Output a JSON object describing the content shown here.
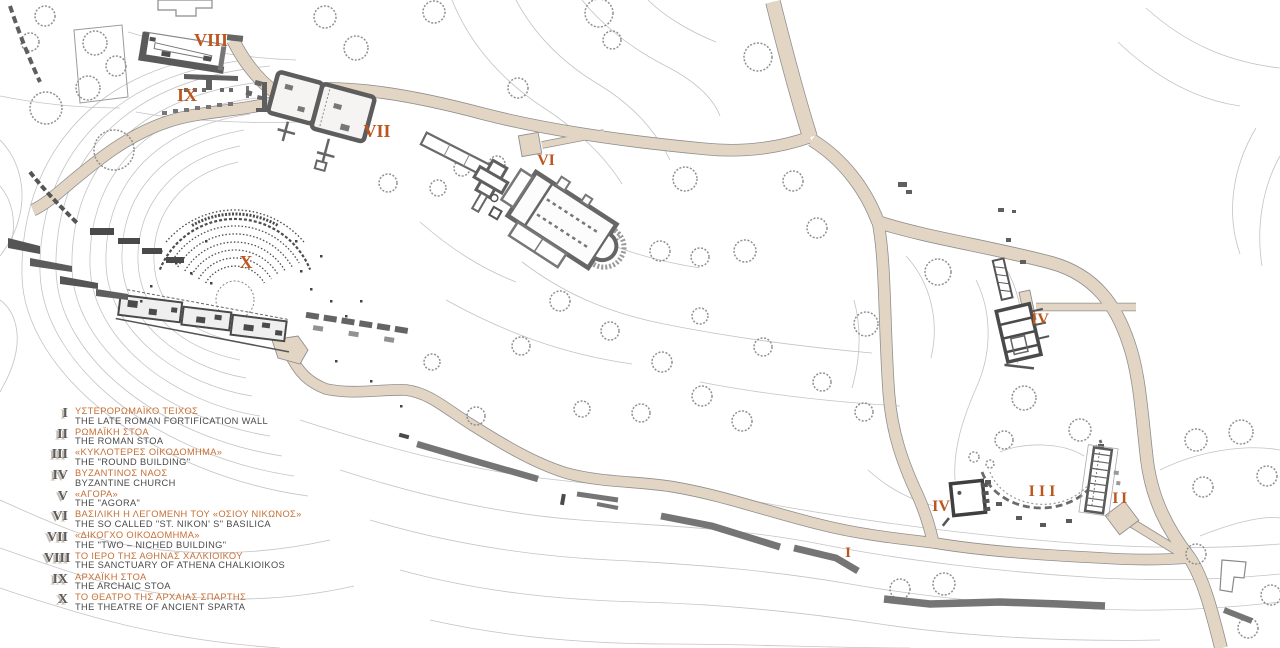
{
  "title": "Archaeological site plan of the acropolis of ancient Sparta",
  "colors": {
    "road_fill": "#e3d5c3",
    "road_edge": "#8f8f8f",
    "label_orange": "#bc561e",
    "legend_greek": "#c66f35",
    "legend_text": "#4a4a4a",
    "numeral_gray": "#5c5c5c",
    "wall_gray": "#757575",
    "contour_gray": "#bcbcbc",
    "building_wall": "#5a5a5a"
  },
  "legend": {
    "items": [
      {
        "numeral": "I",
        "greek": "ΥΣΤΕΡΟΡΩΜΑΪΚΟ ΤΕΙΧΟΣ",
        "english": "THE LATE ROMAN FORTIFICATION WALL"
      },
      {
        "numeral": "II",
        "greek": "ΡΩΜΑΪΚΗ ΣΤΟΑ",
        "english": "THE ROMAN STOA"
      },
      {
        "numeral": "III",
        "greek": "«ΚΥΚΛΟΤΕΡΕΣ ΟΙΚΟΔΟΜΗΜΑ»",
        "english": "THE \"ROUND BUILDING\""
      },
      {
        "numeral": "IV",
        "greek": "ΒΥΖΑΝΤΙΝΟΣ ΝΑΟΣ",
        "english": "BYZANTINE CHURCH"
      },
      {
        "numeral": "V",
        "greek": "«ΑΓΟΡΑ»",
        "english": "THE \"AGORA\""
      },
      {
        "numeral": "VI",
        "greek": "ΒΑΣΙΛΙΚΗ Η ΛΕΓΟΜΕΝΗ ΤΟΥ «ΟΣΙΟΥ ΝΙΚΩΝΟΣ»",
        "english": "THE SO CALLED \"ST. NIKON' S\" BASILICA"
      },
      {
        "numeral": "VII",
        "greek": "«ΔΙΚΟΓΧΟ ΟΙΚΟΔΟΜΗΜΑ»",
        "english": "THE \"TWO – NICHED BUILDING\""
      },
      {
        "numeral": "VIII",
        "greek": "ΤΟ ΙΕΡΟ ΤΗΣ ΑΘΗΝΑΣ ΧΑΛΚΙΟΙΚΟΥ",
        "english": "THE SANCTUARY OF ATHENA CHALKIOIKOS"
      },
      {
        "numeral": "IX",
        "greek": "ΑΡΧΑΪΚΗ ΣΤΟΑ",
        "english": "THE ARCHAIC STOA"
      },
      {
        "numeral": "X",
        "greek": "ΤΟ ΘΕΑΤΡΟ ΤΗΣ ΑΡΧΑΙΑΣ ΣΠΑΡΤΗΣ",
        "english": "THE THEATRE OF ANCIENT SPARTA"
      }
    ]
  },
  "map_labels": [
    {
      "id": "sanctuary-athena",
      "text": "VIII"
    },
    {
      "id": "archaic-stoa",
      "text": "IX"
    },
    {
      "id": "two-niched",
      "text": "VII"
    },
    {
      "id": "nikon-basilica",
      "text": "VI"
    },
    {
      "id": "theatre",
      "text": "X"
    },
    {
      "id": "byzantine-church-n",
      "text": "IV"
    },
    {
      "id": "byzantine-church-s",
      "text": "IV"
    },
    {
      "id": "round-building",
      "text": "III"
    },
    {
      "id": "roman-stoa",
      "text": "II"
    },
    {
      "id": "fortification-wall",
      "text": "I"
    }
  ]
}
